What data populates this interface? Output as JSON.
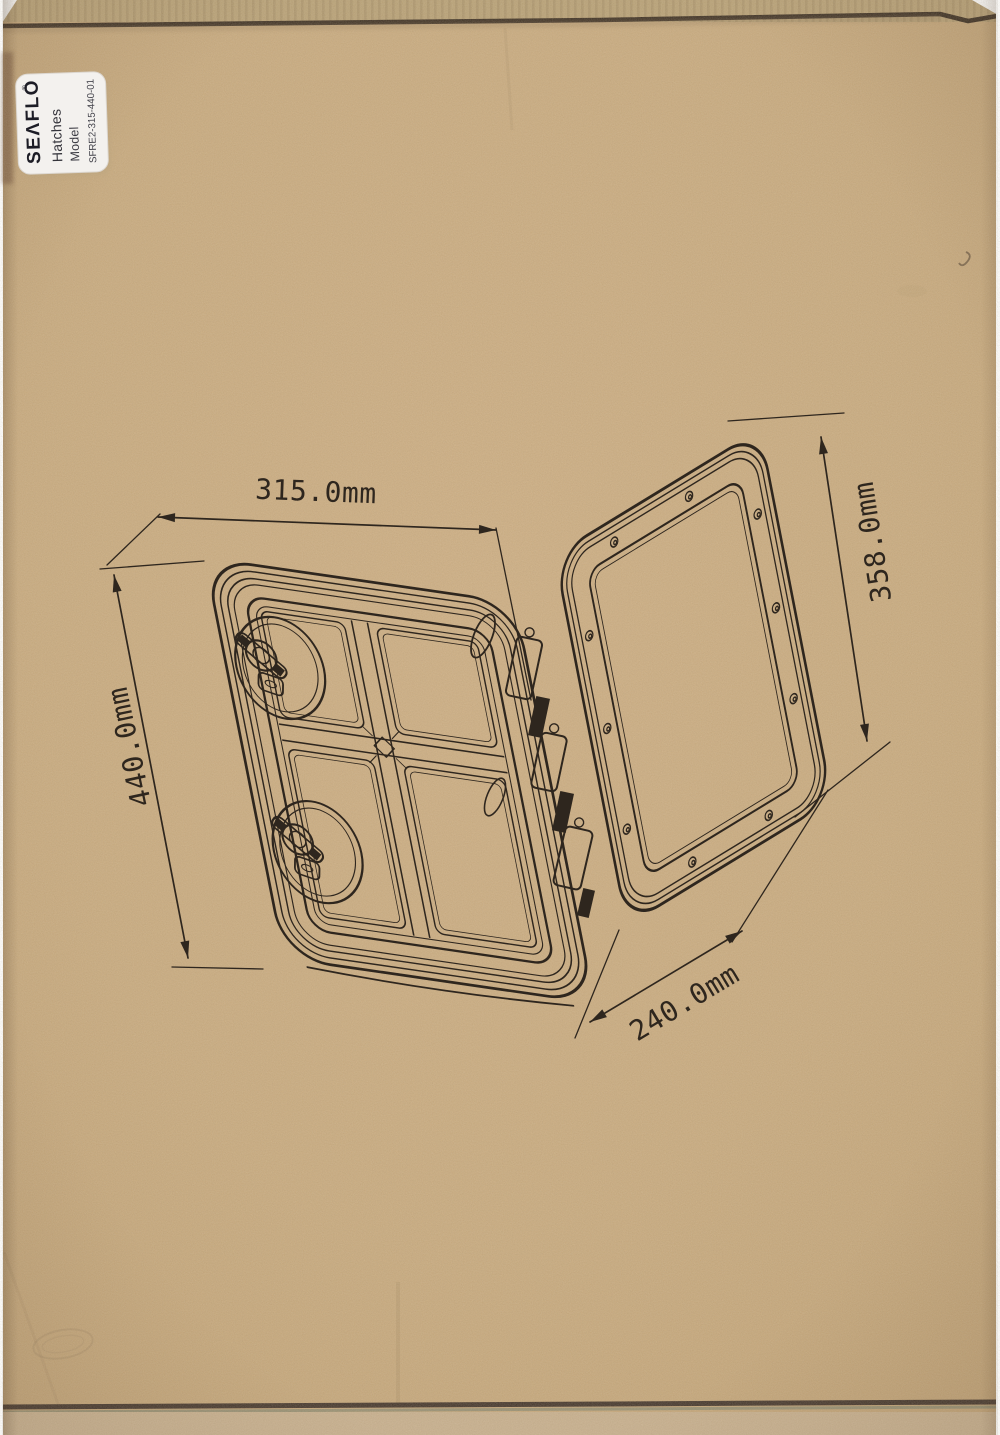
{
  "label": {
    "brand": "SEΛFLO",
    "registered": "®",
    "product": "Hatches",
    "field_model": "Model",
    "model_number": "SFRE2-315-440-01"
  },
  "drawing": {
    "dimensions": {
      "frame_width": "315.0mm",
      "frame_height": "440.0mm",
      "lid_height": "358.0mm",
      "lid_width": "240.0mm"
    }
  },
  "colors": {
    "cardboard": "#c8aa7e",
    "cardboard_dark_edge": "#3a2d20",
    "ink": "#2e261e",
    "label_background": "#f3f1ee"
  }
}
